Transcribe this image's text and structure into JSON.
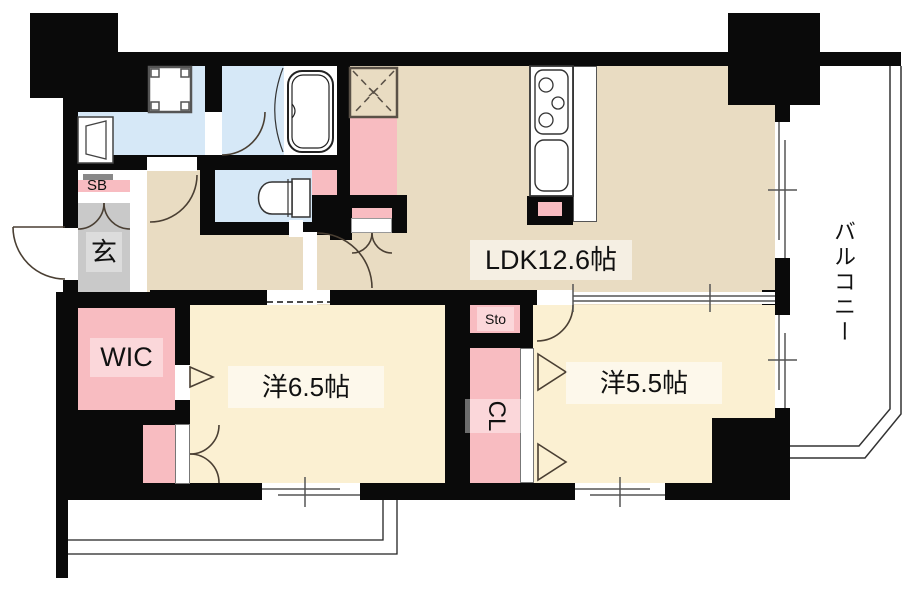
{
  "plan": {
    "type": "apartment-floor-plan",
    "rooms": {
      "ldk": {
        "label": "LDK12.6帖",
        "area_jo": 12.6,
        "color": "#E9DCC2"
      },
      "bedroom1": {
        "label": "洋6.5帖",
        "area_jo": 6.5,
        "color": "#FBF0D2"
      },
      "bedroom2": {
        "label": "洋5.5帖",
        "area_jo": 5.5,
        "color": "#FBF0D2"
      },
      "wic": {
        "label": "WIC",
        "color": "#F8BCC1"
      },
      "closet": {
        "label": "CL",
        "color": "#F8BCC1"
      },
      "storage": {
        "label": "Sto",
        "color": "#F8BCC1"
      },
      "shoebox": {
        "label": "SB",
        "color": "#F8BCC1"
      },
      "entrance": {
        "label": "玄",
        "color": "#C9C9C9"
      },
      "balcony": {
        "label": "バルコニー",
        "color": "#FFFFFF"
      }
    },
    "fixtures": [
      "bathtub",
      "toilet",
      "washbasin",
      "washing-machine-pan",
      "kitchen-stove",
      "kitchen-sink",
      "inspection-hatch"
    ],
    "colors": {
      "wall": "#0A0A0A",
      "ldk_beige": "#E9DCC2",
      "bedroom_cream": "#FBF0D2",
      "wet_area_blue": "#D6E8F7",
      "pillar_pink": "#F8BCC1",
      "entrance_gray": "#C9C9C9",
      "line": "#4a3f33"
    }
  }
}
